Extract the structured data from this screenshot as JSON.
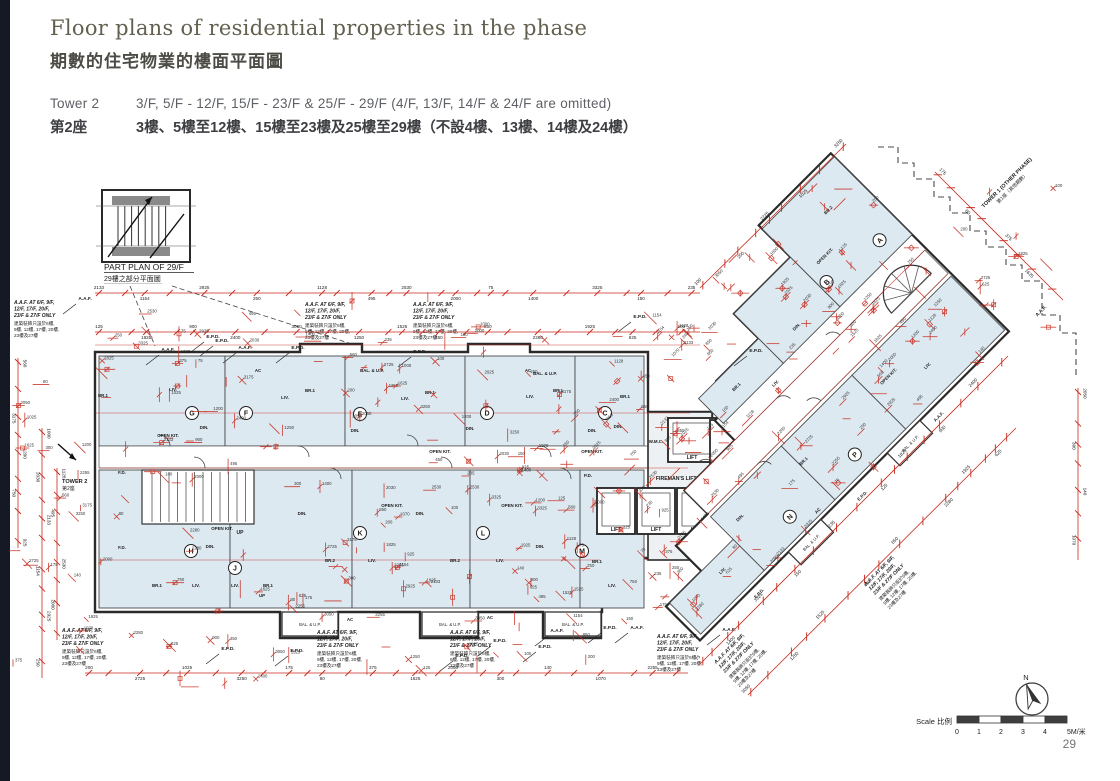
{
  "page": {
    "number": "29"
  },
  "header": {
    "title_en": "Floor plans of residential properties in the phase",
    "title_zh": "期數的住宅物業的樓面平面圖",
    "tower_label_en": "Tower 2",
    "tower_label_zh": "第2座",
    "floors_en": "3/F, 5/F - 12/F, 15/F - 23/F & 25/F - 29/F (4/F, 13/F, 14/F & 24/F are omitted)",
    "floors_zh": "3樓、5樓至12樓、15樓至23樓及25樓至29樓（不設4樓、13樓、14樓及24樓）"
  },
  "part_plan": {
    "label_en": "PART PLAN OF 29/F",
    "label_zh": "29樓之部分平面圖"
  },
  "plan": {
    "tower2_en": "TOWER 2",
    "tower2_zh": "第2座",
    "tower1_en": "TOWER 1 (OTHER PHASE)",
    "tower1_zh": "第1座（其他期數）",
    "labels": {
      "lift": "LIFT",
      "fireman": "FIREMAN'S LIFT LOBBY",
      "liv": "LIV.",
      "din": "DIN.",
      "br1": "BR.1",
      "br2": "BR.2",
      "open_kit": "OPEN KIT.",
      "bal_up": "BAL. & U.P.",
      "ac": "AC",
      "epd": "E.P.D.",
      "aaf": "A.A.F.",
      "fd": "F.D.",
      "pd": "P.D.",
      "up": "UP",
      "wmc": "W.M.C."
    },
    "note": {
      "en1": "A.A.F. AT 6/F, 9/F,",
      "en2": "12/F, 17/F, 20/F,",
      "en3": "23/F & 27/F ONLY",
      "zh1": "建築裝飾只設於6樓,",
      "zh2": "9樓, 12樓, 17樓, 20樓,",
      "zh3": "23樓及27樓"
    },
    "units_main_top": [
      "G",
      "F",
      "E",
      "D",
      "C"
    ],
    "units_main_bottom": [
      "H",
      "J",
      "K",
      "L",
      "M"
    ],
    "units_wing": [
      "A",
      "B",
      "N",
      "P"
    ],
    "dims": [
      "2133",
      "1154",
      "2925",
      "250",
      "1128",
      "495",
      "2530",
      "2000",
      "75",
      "1400",
      "3325",
      "150",
      "235",
      "125",
      "1825",
      "900",
      "2400",
      "3050",
      "1250",
      "1525",
      "450",
      "850",
      "2280",
      "1925",
      "625",
      "100",
      "200",
      "2725",
      "1025",
      "3250",
      "175",
      "80",
      "375",
      "1625",
      "2050",
      "300",
      "140",
      "1070",
      "2255",
      "560",
      "3175",
      "1200",
      "750",
      "925",
      "1000",
      "2030"
    ]
  },
  "compass": {
    "label": "N"
  },
  "scale": {
    "label": "Scale 比例",
    "ticks": [
      "0",
      "1",
      "2",
      "3",
      "4",
      "5M/米"
    ]
  }
}
